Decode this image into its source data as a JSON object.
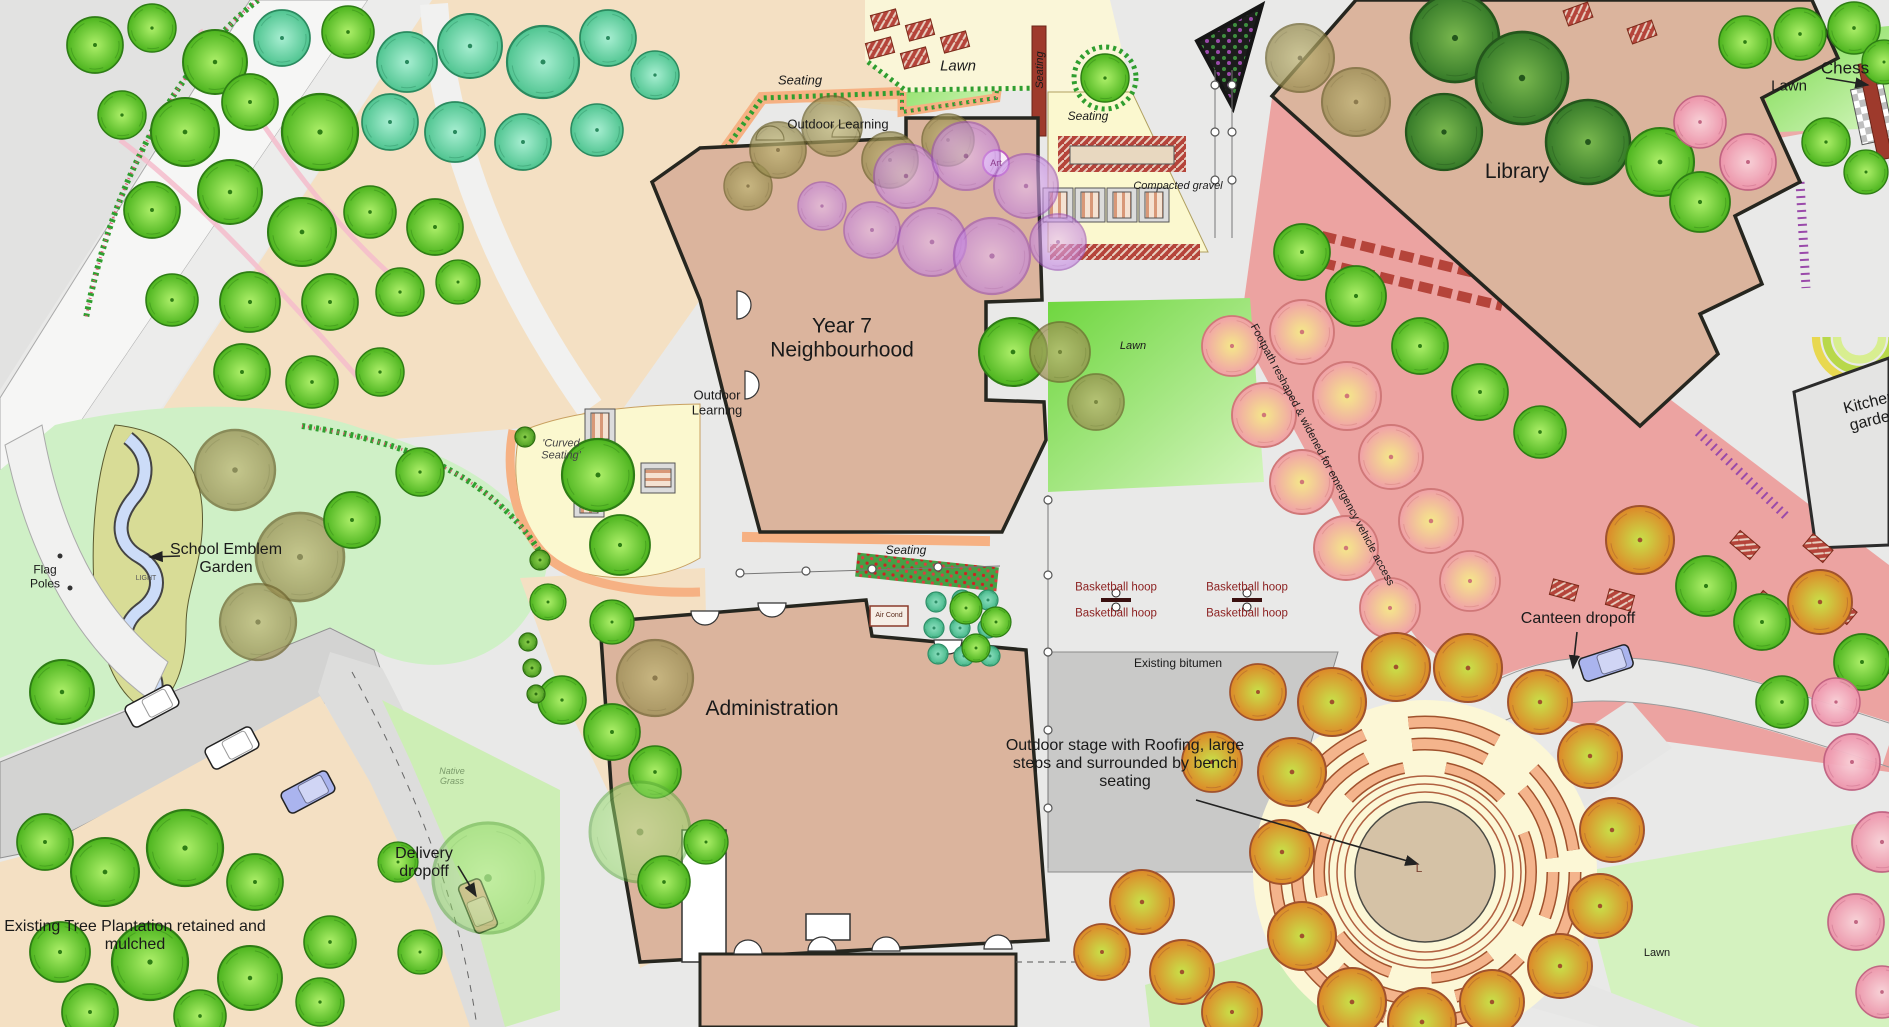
{
  "map": {
    "labels": {
      "seating_top": "Seating",
      "lawn_top": "Lawn",
      "outdoor_learning_top": "Outdoor Learning",
      "art": "Art",
      "seating_vert": "Seating",
      "seating_gravel": "Seating",
      "compacted_gravel": "Compacted gravel",
      "chess": "Chess",
      "lawn_chess": "Lawn",
      "library": "Library",
      "year7": "Year 7 Neighbourhood",
      "outdoor_learning_left": "Outdoor Learning",
      "school_emblem_garden": "School Emblem Garden",
      "flag_poles": "Flag Poles",
      "light": "LIGHT",
      "curved_seating": "'Curved Seating'",
      "seating_mid": "Seating",
      "air_cond": "Air Cond",
      "administration": "Administration",
      "basketball_hoop": "Basketball hoop",
      "existing_bitumen": "Existing bitumen",
      "outdoor_stage": "Outdoor stage with Roofing, large steps and surrounded by bench seating",
      "stage_center_mark": "L",
      "lawn_stage": "Lawn",
      "lawn_mid": "Lawn",
      "canteen_dropoff": "Canteen dropoff",
      "delivery_dropoff": "Delivery dropoff",
      "tree_plantation": "Existing Tree Plantation retained and mulched",
      "footpath_note": "Footpath reshaped & widened for emergency vehicle access",
      "kitchen_garden": "Kitchen garden",
      "native_grass": "Native Grass"
    },
    "colors": {
      "building": "#dbb49d",
      "pink_plaza": "#eca3a1",
      "lawn_bright": "#6ed63e",
      "pale_yellow": "#fbf8cf",
      "peach_ground": "#f4e0c3",
      "bitumen": "#c9c9c8",
      "orange_edge": "#f6b183",
      "dark_red_wall": "#9e3a2c",
      "basketball_text": "#8b1f1f",
      "stream_blue": "#ccdcf8"
    },
    "trees": [
      [
        95,
        45,
        28,
        "g"
      ],
      [
        152,
        28,
        24,
        "g"
      ],
      [
        215,
        62,
        32,
        "g"
      ],
      [
        282,
        38,
        28,
        "t"
      ],
      [
        348,
        32,
        26,
        "g"
      ],
      [
        407,
        62,
        30,
        "t"
      ],
      [
        470,
        46,
        32,
        "t"
      ],
      [
        543,
        62,
        36,
        "t"
      ],
      [
        608,
        38,
        28,
        "t"
      ],
      [
        655,
        75,
        24,
        "t"
      ],
      [
        122,
        115,
        24,
        "g"
      ],
      [
        185,
        132,
        34,
        "g"
      ],
      [
        250,
        102,
        28,
        "g"
      ],
      [
        320,
        132,
        38,
        "g"
      ],
      [
        390,
        122,
        28,
        "t"
      ],
      [
        455,
        132,
        30,
        "t"
      ],
      [
        523,
        142,
        28,
        "t"
      ],
      [
        597,
        130,
        26,
        "t"
      ],
      [
        152,
        210,
        28,
        "g"
      ],
      [
        230,
        192,
        32,
        "g"
      ],
      [
        302,
        232,
        34,
        "g"
      ],
      [
        370,
        212,
        26,
        "g"
      ],
      [
        435,
        227,
        28,
        "g"
      ],
      [
        172,
        300,
        26,
        "g"
      ],
      [
        250,
        302,
        30,
        "g"
      ],
      [
        330,
        302,
        28,
        "g"
      ],
      [
        400,
        292,
        24,
        "g"
      ],
      [
        458,
        282,
        22,
        "g"
      ],
      [
        242,
        372,
        28,
        "g"
      ],
      [
        312,
        382,
        26,
        "g"
      ],
      [
        380,
        372,
        24,
        "g"
      ],
      [
        235,
        470,
        40,
        "o"
      ],
      [
        300,
        557,
        44,
        "o"
      ],
      [
        258,
        622,
        38,
        "o"
      ],
      [
        352,
        520,
        28,
        "g"
      ],
      [
        420,
        472,
        24,
        "g"
      ],
      [
        598,
        475,
        36,
        "g"
      ],
      [
        620,
        545,
        30,
        "g"
      ],
      [
        548,
        602,
        18,
        "g"
      ],
      [
        612,
        622,
        22,
        "g"
      ],
      [
        562,
        700,
        24,
        "g"
      ],
      [
        612,
        732,
        28,
        "g"
      ],
      [
        655,
        772,
        26,
        "g"
      ],
      [
        640,
        832,
        50,
        "lg"
      ],
      [
        655,
        678,
        38,
        "o"
      ],
      [
        748,
        186,
        24,
        "o"
      ],
      [
        778,
        150,
        28,
        "o"
      ],
      [
        832,
        126,
        30,
        "o"
      ],
      [
        890,
        160,
        28,
        "o"
      ],
      [
        948,
        140,
        26,
        "o"
      ],
      [
        822,
        206,
        24,
        "p"
      ],
      [
        872,
        230,
        28,
        "p"
      ],
      [
        906,
        176,
        32,
        "p"
      ],
      [
        966,
        156,
        34,
        "p"
      ],
      [
        1026,
        186,
        32,
        "p"
      ],
      [
        932,
        242,
        34,
        "p"
      ],
      [
        992,
        256,
        38,
        "p"
      ],
      [
        1058,
        242,
        28,
        "p"
      ],
      [
        1013,
        352,
        34,
        "g"
      ],
      [
        1060,
        352,
        30,
        "o"
      ],
      [
        1096,
        402,
        28,
        "o"
      ],
      [
        936,
        602,
        10,
        "tl"
      ],
      [
        962,
        600,
        10,
        "tl"
      ],
      [
        988,
        600,
        10,
        "tl"
      ],
      [
        934,
        628,
        10,
        "tl"
      ],
      [
        960,
        628,
        10,
        "tl"
      ],
      [
        988,
        628,
        10,
        "tl"
      ],
      [
        938,
        654,
        10,
        "tl"
      ],
      [
        964,
        656,
        10,
        "tl"
      ],
      [
        990,
        656,
        10,
        "tl"
      ],
      [
        966,
        608,
        16,
        "g"
      ],
      [
        996,
        622,
        15,
        "g"
      ],
      [
        976,
        648,
        14,
        "g"
      ],
      [
        62,
        692,
        32,
        "g"
      ],
      [
        45,
        842,
        28,
        "g"
      ],
      [
        105,
        872,
        34,
        "g"
      ],
      [
        185,
        848,
        38,
        "g"
      ],
      [
        255,
        882,
        28,
        "g"
      ],
      [
        60,
        952,
        30,
        "g"
      ],
      [
        150,
        962,
        38,
        "g"
      ],
      [
        250,
        978,
        32,
        "g"
      ],
      [
        330,
        942,
        26,
        "g"
      ],
      [
        90,
        1012,
        28,
        "g"
      ],
      [
        200,
        1016,
        26,
        "g"
      ],
      [
        320,
        1002,
        24,
        "g"
      ],
      [
        398,
        862,
        20,
        "g"
      ],
      [
        420,
        952,
        22,
        "g"
      ],
      [
        488,
        878,
        55,
        "lg"
      ],
      [
        706,
        842,
        22,
        "g"
      ],
      [
        664,
        882,
        26,
        "g"
      ],
      [
        1300,
        58,
        34,
        "o"
      ],
      [
        1356,
        102,
        34,
        "o"
      ],
      [
        1455,
        38,
        44,
        "d"
      ],
      [
        1522,
        78,
        46,
        "d"
      ],
      [
        1588,
        142,
        42,
        "d"
      ],
      [
        1444,
        132,
        38,
        "d"
      ],
      [
        1660,
        162,
        34,
        "g"
      ],
      [
        1700,
        202,
        30,
        "g"
      ],
      [
        1745,
        42,
        26,
        "g"
      ],
      [
        1800,
        34,
        26,
        "g"
      ],
      [
        1854,
        28,
        26,
        "g"
      ],
      [
        1884,
        62,
        22,
        "g"
      ],
      [
        1232,
        346,
        30,
        "f"
      ],
      [
        1264,
        415,
        32,
        "f"
      ],
      [
        1302,
        482,
        32,
        "f"
      ],
      [
        1346,
        548,
        32,
        "f"
      ],
      [
        1390,
        608,
        30,
        "f"
      ],
      [
        1302,
        332,
        32,
        "f"
      ],
      [
        1347,
        396,
        34,
        "f"
      ],
      [
        1391,
        457,
        32,
        "f"
      ],
      [
        1431,
        521,
        32,
        "f"
      ],
      [
        1470,
        581,
        30,
        "f"
      ],
      [
        1302,
        252,
        28,
        "g"
      ],
      [
        1356,
        296,
        30,
        "g"
      ],
      [
        1420,
        346,
        28,
        "g"
      ],
      [
        1480,
        392,
        28,
        "g"
      ],
      [
        1540,
        432,
        26,
        "g"
      ],
      [
        1640,
        540,
        34,
        "a"
      ],
      [
        1706,
        586,
        30,
        "g"
      ],
      [
        1762,
        622,
        28,
        "g"
      ],
      [
        1820,
        602,
        32,
        "a"
      ],
      [
        1862,
        662,
        28,
        "g"
      ],
      [
        1782,
        702,
        26,
        "g"
      ],
      [
        1700,
        122,
        26,
        "pk"
      ],
      [
        1748,
        162,
        28,
        "pk"
      ],
      [
        1836,
        702,
        24,
        "pk"
      ],
      [
        1852,
        762,
        28,
        "pk"
      ],
      [
        1882,
        842,
        30,
        "pk"
      ],
      [
        1856,
        922,
        28,
        "pk"
      ],
      [
        1882,
        992,
        26,
        "pk"
      ],
      [
        1826,
        142,
        24,
        "g"
      ],
      [
        1866,
        172,
        22,
        "g"
      ],
      [
        1292,
        772,
        34,
        "a"
      ],
      [
        1332,
        702,
        34,
        "a"
      ],
      [
        1396,
        667,
        34,
        "a"
      ],
      [
        1468,
        668,
        34,
        "a"
      ],
      [
        1540,
        702,
        32,
        "a"
      ],
      [
        1590,
        756,
        32,
        "a"
      ],
      [
        1612,
        830,
        32,
        "a"
      ],
      [
        1600,
        906,
        32,
        "a"
      ],
      [
        1560,
        966,
        32,
        "a"
      ],
      [
        1282,
        852,
        32,
        "a"
      ],
      [
        1302,
        936,
        34,
        "a"
      ],
      [
        1352,
        1002,
        34,
        "a"
      ],
      [
        1422,
        1022,
        34,
        "a"
      ],
      [
        1492,
        1002,
        32,
        "a"
      ],
      [
        1258,
        692,
        28,
        "a"
      ],
      [
        1212,
        762,
        30,
        "a"
      ],
      [
        1142,
        902,
        32,
        "a"
      ],
      [
        1182,
        972,
        32,
        "a"
      ],
      [
        1232,
        1012,
        30,
        "a"
      ],
      [
        1102,
        952,
        28,
        "a"
      ],
      [
        1105,
        78,
        24,
        "g"
      ],
      [
        528,
        642,
        9,
        "s"
      ],
      [
        532,
        668,
        9,
        "s"
      ],
      [
        536,
        694,
        9,
        "s"
      ],
      [
        525,
        437,
        10,
        "s"
      ],
      [
        540,
        560,
        10,
        "s"
      ]
    ],
    "cars": [
      [
        152,
        706,
        -28,
        "#ffffff"
      ],
      [
        232,
        748,
        -28,
        "#ffffff"
      ],
      [
        308,
        792,
        -28,
        "#aab4ee"
      ],
      [
        478,
        906,
        68,
        "#f5a5a5"
      ],
      [
        1606,
        663,
        -18,
        "#aab4ee"
      ]
    ],
    "tables_red": [
      [
        1578,
        14,
        -20
      ],
      [
        1642,
        32,
        -20
      ],
      [
        885,
        20,
        -15
      ],
      [
        920,
        30,
        -15
      ],
      [
        955,
        42,
        -15
      ],
      [
        880,
        48,
        -15
      ],
      [
        915,
        58,
        -15
      ],
      [
        1564,
        590,
        15
      ],
      [
        1620,
        600,
        15
      ],
      [
        1745,
        545,
        40
      ],
      [
        1818,
        548,
        40
      ],
      [
        1768,
        605,
        40
      ],
      [
        1842,
        610,
        40
      ],
      [
        1876,
        668,
        40
      ]
    ],
    "tables_stripe": [
      [
        1058,
        205,
        0
      ],
      [
        1090,
        205,
        0
      ],
      [
        1122,
        205,
        0
      ],
      [
        1154,
        205,
        0
      ],
      [
        600,
        426,
        0
      ],
      [
        658,
        478,
        90
      ],
      [
        589,
        500,
        0
      ]
    ],
    "hoops": [
      [
        1116,
        600
      ],
      [
        1247,
        600
      ]
    ]
  }
}
